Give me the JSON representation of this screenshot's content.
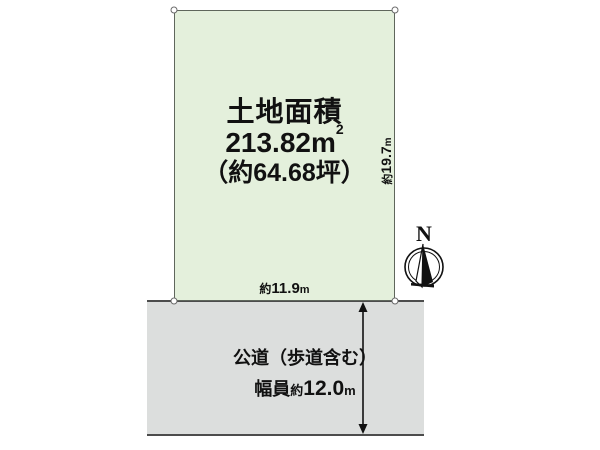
{
  "plot": {
    "title": "土地面積",
    "area": {
      "value": "213.82",
      "unit": "m",
      "exponent": "2"
    },
    "tsubo": "（約64.68坪）"
  },
  "dimensions": {
    "frontage": {
      "prefix": "約",
      "value": "11.9",
      "unit": "m"
    },
    "depth": {
      "prefix": "約",
      "value": "19.7",
      "unit": "m"
    }
  },
  "road": {
    "name": "公道（歩道含む）",
    "width": {
      "label": "幅員",
      "prefix": "約",
      "value": "12.0",
      "unit": "m"
    }
  },
  "compass": {
    "label": "N"
  },
  "colors": {
    "plot_fill": "#e4f0dc",
    "plot_border": "#5f665c",
    "road_fill": "#dcdedd",
    "line": "#4c4c4c",
    "text": "#111111"
  }
}
